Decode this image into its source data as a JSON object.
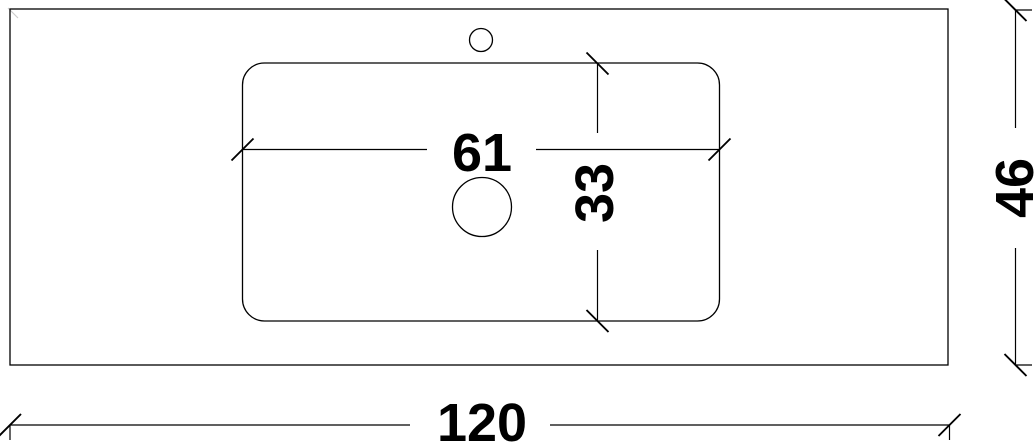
{
  "drawing": {
    "kind": "countertop-basin-plan-technical-drawing",
    "colors": {
      "line": "#000000",
      "background": "#ffffff",
      "faint_corner_mark": "#cccccc"
    },
    "dimensions": {
      "basin_width": "61",
      "basin_depth": "33",
      "countertop_width": "120",
      "countertop_depth": "46"
    },
    "shapes": {
      "countertop_outline": "rectangle",
      "basin_outline": "rounded-rectangle",
      "faucet_hole": "small-circle",
      "drain_hole": "large-circle"
    }
  }
}
